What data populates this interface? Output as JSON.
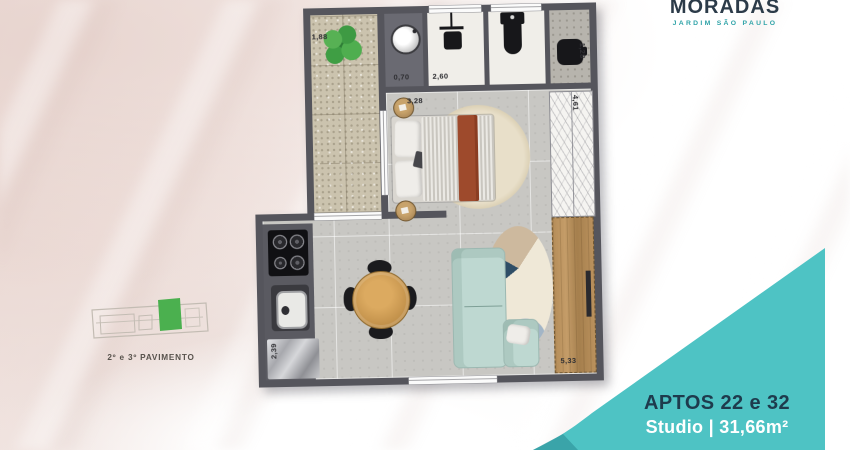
{
  "brand": {
    "name": "MORADAS",
    "subtitle": "JARDIM SÃO PAULO"
  },
  "key_plan": {
    "caption": "2º e 3º PAVIMENTO"
  },
  "unit_panel": {
    "apartments": "APTOS 22 e 32",
    "type_and_area": "Studio | 31,66m²"
  },
  "floor_plan": {
    "dimensions": {
      "balcony_width": "1,88",
      "laundry_width": "0,70",
      "bathroom_width": "2,60",
      "washbasin_depth": "1,28",
      "bedroom_width": "3,28",
      "wardrobe_length": "4,61",
      "kitchen_counter_length": "2,39",
      "living_length": "5,33"
    }
  },
  "colors": {
    "teal": "#4ec3c4",
    "teal_dark": "#379fa4",
    "navy": "#1e3b4d",
    "logo_navy": "#2c3b49",
    "logo_teal": "#2fa3a8",
    "wall": "#55555c",
    "highlight_green": "#4bb04f"
  }
}
